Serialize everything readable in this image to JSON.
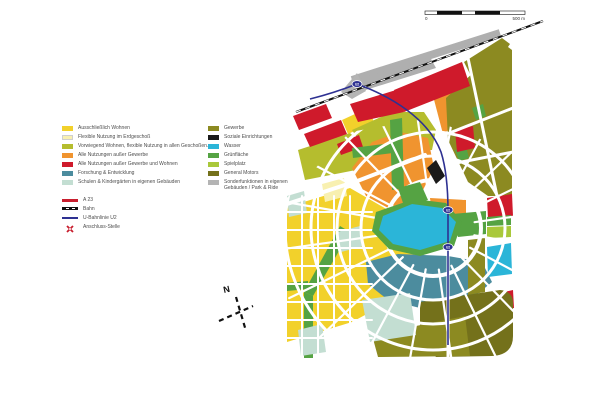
{
  "colors": {
    "wohnen_yellow": "#F2D12B",
    "flex_pale": "#F8F0B0",
    "vorwiegend_olivegreen": "#B5BD2E",
    "mixed_orange": "#F0942F",
    "mixed_red": "#CF1A2B",
    "forschung_teal": "#4C8C9E",
    "schulen_mint": "#C3DED2",
    "gewerbe_olive": "#8C8A21",
    "soziale_black": "#1A1A1A",
    "wasser_cyan": "#2BB5D8",
    "gruen_green": "#55A343",
    "spielplatz_lime": "#A9C83A",
    "gm_darkolive": "#74711B",
    "sonder_gray": "#B4B4B4",
    "a23_red": "#C81E2E",
    "bahn_black": "#111111",
    "u2_navy": "#2E3192",
    "railway_gray": "#AFAFAF"
  },
  "legend": {
    "left": [
      {
        "label": "Ausschließlich Wohnen"
      },
      {
        "label": "Flexible Nutzung im Erdgeschoß"
      },
      {
        "label": "Vorwiegend Wohnen, flexible Nutzung in allen Geschoßen."
      },
      {
        "label": "Alle Nutzungen außer Gewerbe"
      },
      {
        "label": "Alle Nutzungen außer Gewerbe und Wohnen"
      },
      {
        "label": "Forschung & Entwicklung"
      },
      {
        "label": "Schulen & Kindergärten in eigenen Gebäuden"
      }
    ],
    "lines": [
      {
        "label": "A 23"
      },
      {
        "label": "Bahn"
      },
      {
        "label": "U-Bahnlinie U2"
      },
      {
        "label": "Anschluss-Stelle"
      }
    ],
    "right": [
      {
        "label": "Gewerbe"
      },
      {
        "label": "Soziale Einrichtungen"
      },
      {
        "label": "Wasser"
      },
      {
        "label": "Grünfläche"
      },
      {
        "label": "Spielplatz"
      },
      {
        "label": "General Motors"
      },
      {
        "label": "Sonderfunktionen in eigenen Gebäuden / Park & Ride"
      }
    ]
  },
  "scalebar": {
    "zero": "0",
    "max": "500 m"
  },
  "compass": {
    "label": "N"
  },
  "map": {
    "station_label": "U2"
  }
}
